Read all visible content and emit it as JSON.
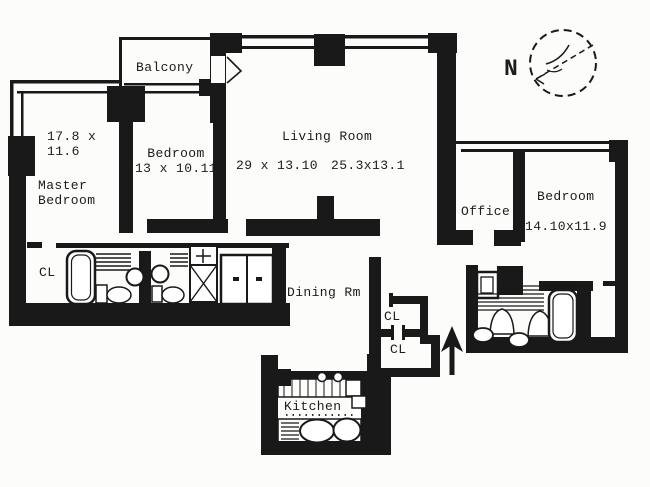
{
  "colors": {
    "ink": "#191919",
    "paper": "#fcfcfa"
  },
  "compass": {
    "label": "N"
  },
  "rooms": {
    "balcony": {
      "label": "Balcony"
    },
    "master_bedroom": {
      "dims": "17.8 x\n11.6",
      "name": "Master\nBedroom"
    },
    "bedroom_2": {
      "name_and_dims": "Bedroom\n13 x 10.11"
    },
    "living_room": {
      "name": "Living Room",
      "dims_left": "29 x 13.10",
      "dims_right": "25.3x13.1"
    },
    "office": {
      "name": "Office"
    },
    "bedroom_3": {
      "name": "Bedroom",
      "dims": "14.10x11.9"
    },
    "dining_room": {
      "name": "Dining Rm"
    },
    "kitchen": {
      "name": "Kitchen"
    },
    "closet_bath_hall": {
      "label": "CL"
    },
    "closet_entry_upper": {
      "label": "CL"
    },
    "closet_entry_lower": {
      "label": "CL"
    }
  }
}
